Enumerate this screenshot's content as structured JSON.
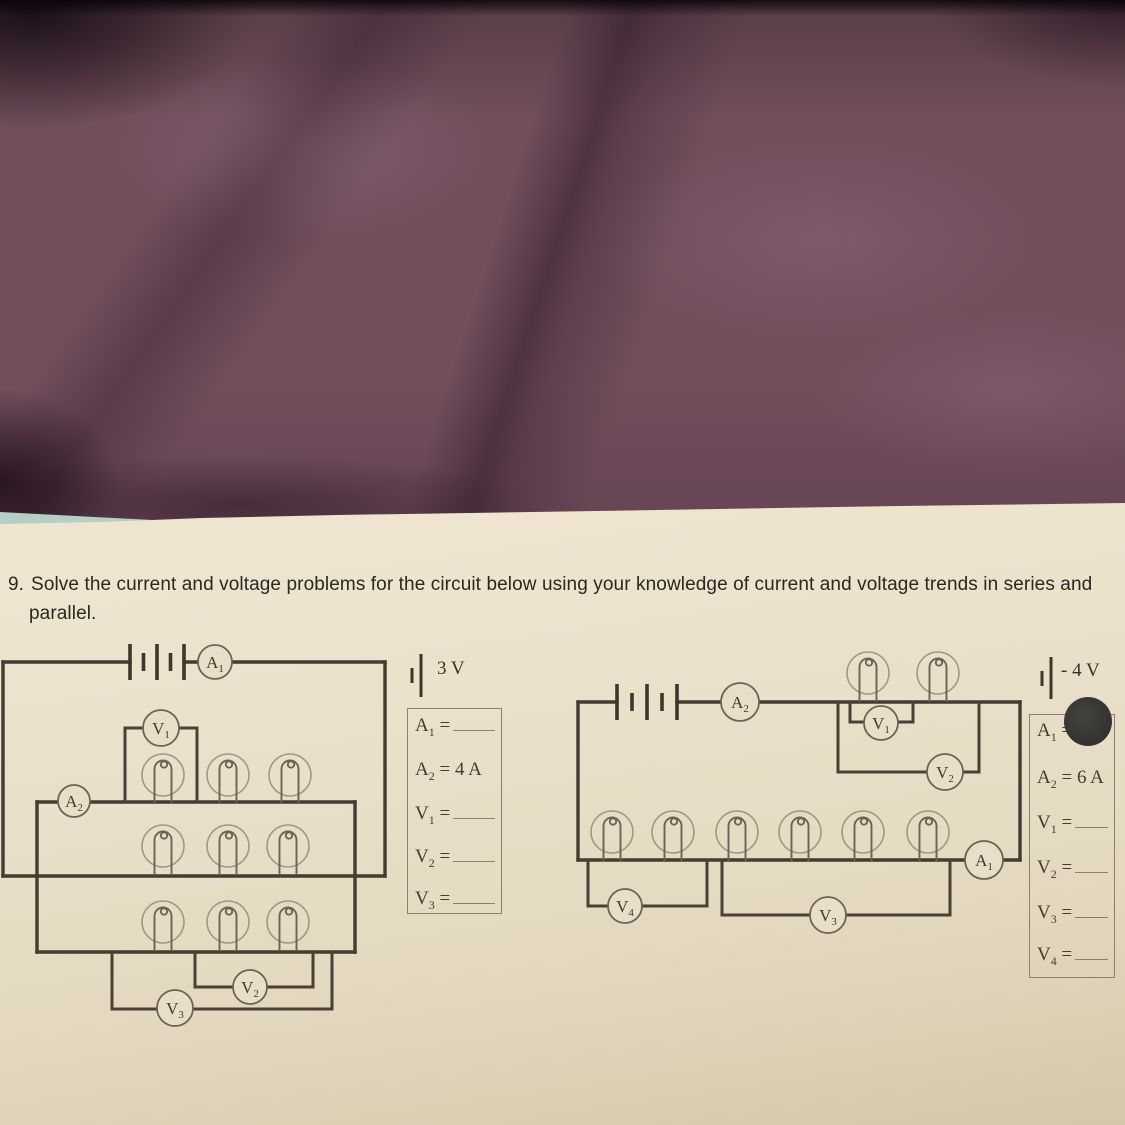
{
  "question": {
    "number": "9.",
    "line1": "Solve the current and voltage problems for the circuit below using your knowledge of current and voltage trends in series and",
    "line2": "parallel."
  },
  "left_circuit": {
    "battery_voltage_label": "3 V",
    "meters": {
      "a1": {
        "main": "A",
        "sub": "1"
      },
      "a2": {
        "main": "A",
        "sub": "2"
      },
      "v1": {
        "main": "V",
        "sub": "1"
      },
      "v2": {
        "main": "V",
        "sub": "2"
      },
      "v3": {
        "main": "V",
        "sub": "3"
      }
    },
    "bulb_count": 9,
    "answer_box": {
      "rows": [
        {
          "sym": "A",
          "sub": "1",
          "eq": "=",
          "value": ""
        },
        {
          "sym": "A",
          "sub": "2",
          "eq": "=",
          "value": "4 A"
        },
        {
          "sym": "V",
          "sub": "1",
          "eq": "=",
          "value": ""
        },
        {
          "sym": "V",
          "sub": "2",
          "eq": "=",
          "value": ""
        },
        {
          "sym": "V",
          "sub": "3",
          "eq": "=",
          "value": ""
        }
      ]
    }
  },
  "right_circuit": {
    "battery_voltage_label": "- 4 V",
    "meters": {
      "a2": {
        "main": "A",
        "sub": "2"
      },
      "a1": {
        "main": "A",
        "sub": "1"
      },
      "v1": {
        "main": "V",
        "sub": "1"
      },
      "v2": {
        "main": "V",
        "sub": "2"
      },
      "v3": {
        "main": "V",
        "sub": "3"
      },
      "v4": {
        "main": "V",
        "sub": "4"
      }
    },
    "bulb_count": 8,
    "icons": {
      "ink_dot": "filled-circle"
    },
    "answer_box": {
      "rows": [
        {
          "sym": "A",
          "sub": "1",
          "eq": "=",
          "value": ""
        },
        {
          "sym": "A",
          "sub": "2",
          "eq": "=",
          "value": "6 A"
        },
        {
          "sym": "V",
          "sub": "1",
          "eq": "=",
          "value": ""
        },
        {
          "sym": "V",
          "sub": "2",
          "eq": "=",
          "value": ""
        },
        {
          "sym": "V",
          "sub": "3",
          "eq": "=",
          "value": ""
        },
        {
          "sym": "V",
          "sub": "4",
          "eq": "=",
          "value": ""
        }
      ]
    }
  }
}
